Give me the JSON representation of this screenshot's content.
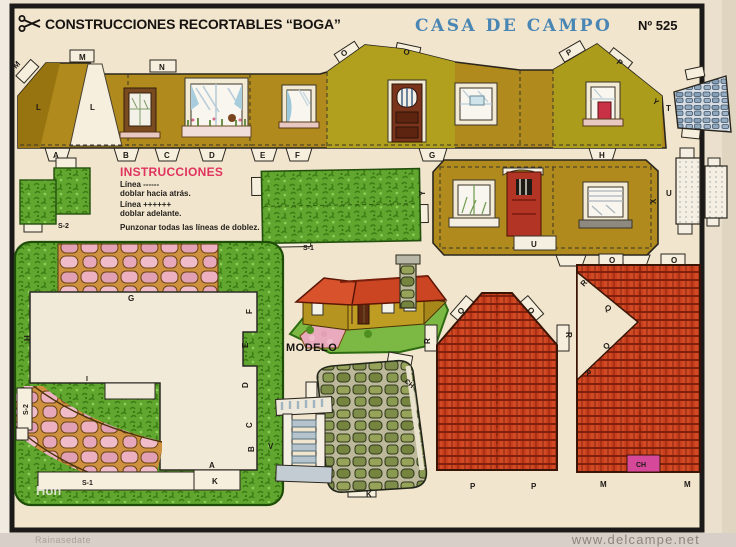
{
  "header": {
    "scissors_icon": "scissors",
    "brand": "CONSTRUCCIONES RECORTABLES “BOGA”",
    "title": "CASA DE CAMPO",
    "number": "Nº 525"
  },
  "instructions": {
    "heading": "INSTRUCCIONES",
    "fold_back_label": "Línea ------",
    "fold_back_text": "doblar hacia atrás.",
    "fold_front_label": "Línea ++++++",
    "fold_front_text": "doblar adelante.",
    "punch_text": "Punzonar todas las líneas de doblez."
  },
  "model": {
    "label": "MODELO"
  },
  "pieces": {
    "strip1": {
      "top_tabs": [
        "M",
        "M",
        "N",
        "O",
        "O",
        "P",
        "P"
      ],
      "bottom_tabs": [
        "A",
        "B",
        "C",
        "D",
        "E",
        "F",
        "G",
        "H"
      ],
      "chimney_left": "L",
      "chimney_right": "L",
      "right_edge": "Y"
    },
    "strip2": {
      "left_edge": "Y",
      "door_step": "U",
      "right_edge": "X"
    },
    "t_piece": {
      "label": "T"
    },
    "u_piece": {
      "label": "U"
    },
    "s1_hedge": {
      "label": "S-1"
    },
    "s2_hedge": {
      "label": "S-2"
    },
    "garden": {
      "top_edge": "G",
      "left_edge": "H",
      "right_edge_1": "F",
      "right_edge_2": "E",
      "right_edge_3": "D",
      "right_edge_4": "C",
      "right_edge_5": "B",
      "bottom_corner": "A",
      "bottom_tab": "K",
      "step_label": "I",
      "bottom_strip": "S-1",
      "side_strip": "S-2"
    },
    "roof_left": {
      "tab_1": "R",
      "tab_2": "Q",
      "tab_3": "O",
      "tab_4": "R",
      "bottom_1": "P",
      "bottom_2": "P"
    },
    "roof_right": {
      "top_tab_1": "O",
      "top_tab_2": "O",
      "notch_top": "R",
      "notch_upper": "Q",
      "notch_lower": "Q",
      "notch_bottom": "R",
      "bottom_1": "M",
      "bottom_2": "M",
      "chimney_notch": "CH"
    },
    "chimney_wrap": {
      "label_ch": "CH",
      "label_k": "K"
    },
    "v_piece": {
      "label": "V"
    }
  },
  "watermarks": {
    "overlay": "Hon",
    "scan_left": "Rainasedate",
    "scan_right": "www.delcampe.net"
  },
  "colors": {
    "paper_cream": "#f1e5ce",
    "title_blue": "#4a86b4",
    "instructions_red": "#e0335e",
    "wall_ochre": "#b08a1c",
    "gable_olive": "#b0a01e",
    "roof_red": "#d14a24",
    "hedge_green": "#61a72f",
    "stone_pink": "#ecb0c0",
    "magenta_notch": "#d6489a"
  }
}
